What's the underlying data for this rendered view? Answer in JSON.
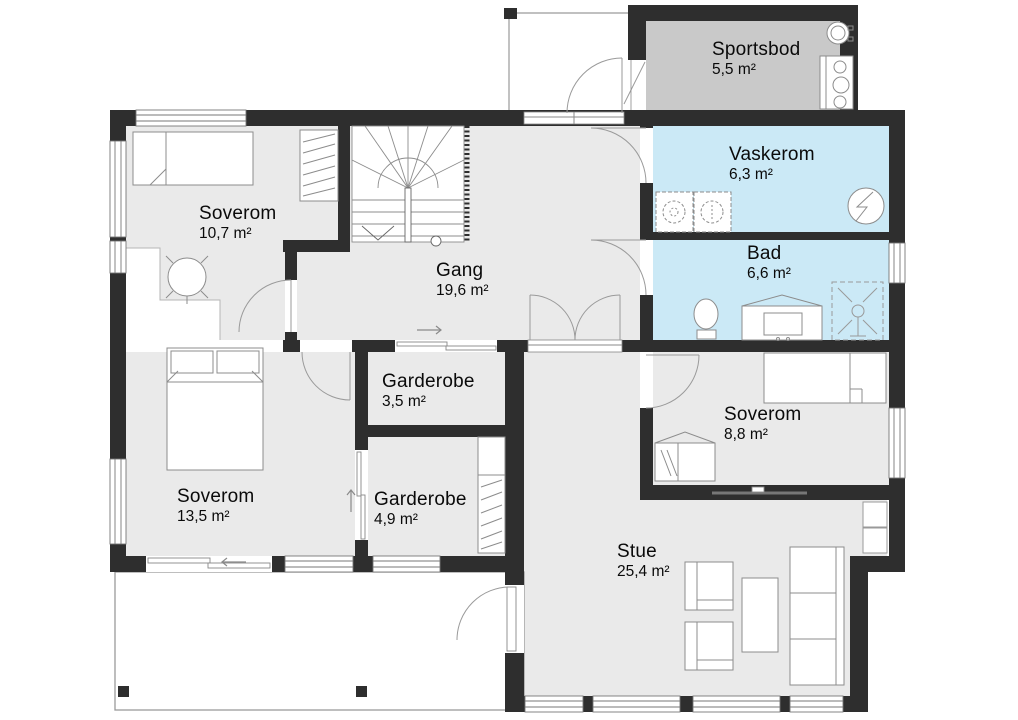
{
  "colors": {
    "wall": "#2e2e2e",
    "floor": "#eaeaea",
    "wet_room": "#cbe9f6",
    "storage": "#c9c9c9",
    "outline": "#8c8c8c",
    "background": "#ffffff"
  },
  "rooms": [
    {
      "name": "Sportsbod",
      "area": "5,5 m²"
    },
    {
      "name": "Vaskerom",
      "area": "6,3 m²"
    },
    {
      "name": "Bad",
      "area": "6,6 m²"
    },
    {
      "name": "Soverom",
      "area": "10,7 m²"
    },
    {
      "name": "Gang",
      "area": "19,6 m²"
    },
    {
      "name": "Garderobe",
      "area": "3,5 m²"
    },
    {
      "name": "Garderobe",
      "area": "4,9 m²"
    },
    {
      "name": "Soverom",
      "area": "13,5 m²"
    },
    {
      "name": "Soverom",
      "area": "8,8 m²"
    },
    {
      "name": "Stue",
      "area": "25,4 m²"
    }
  ],
  "fixtures": [
    "stairs",
    "single-bed",
    "double-bed",
    "wardrobe",
    "office-chair",
    "washing-machine",
    "dryer",
    "water-heater",
    "hot-water-tank",
    "toilet",
    "sink-vanity",
    "shower",
    "tv",
    "armchair",
    "coffee-table",
    "sofa",
    "cabinet",
    "desk",
    "terrace",
    "entry-porch"
  ]
}
